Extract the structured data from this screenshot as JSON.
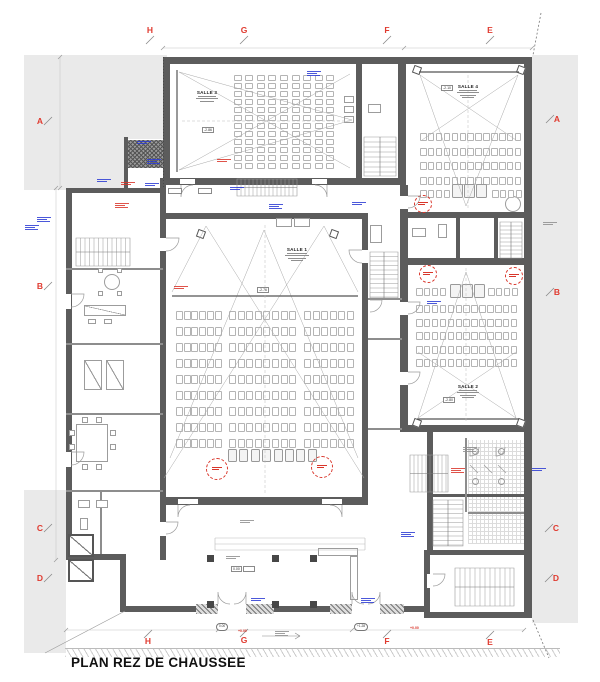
{
  "title": "PLAN REZ DE CHAUSSEE",
  "grid": {
    "top": [
      "H",
      "G",
      "F",
      "E"
    ],
    "bottom": [
      "H",
      "G",
      "F",
      "E"
    ],
    "left": [
      "A",
      "B",
      "C",
      "D"
    ],
    "right": [
      "A",
      "B",
      "C",
      "D"
    ]
  },
  "salles": {
    "salle1": {
      "label": "SALLE 1",
      "level": "-2.76"
    },
    "salle2": {
      "label": "SALLE 2",
      "level": "-2.80"
    },
    "salle3": {
      "label": "SALLE 3",
      "level": "-2.86"
    },
    "salle4": {
      "label": "SALLE 4",
      "level": "-2.10"
    }
  },
  "levels": {
    "hall": "0.00",
    "entry_left": "+0.00",
    "entry_right": "+0.00",
    "oval_left": "0.00",
    "oval_right": "+1.28"
  },
  "colors": {
    "grid_letter": "#e03a2f",
    "annotation_red": "#d9352a",
    "annotation_blue": "#2b3bd4",
    "annotation_gray": "#8f8f8f",
    "wall": "#5c5c5c"
  }
}
